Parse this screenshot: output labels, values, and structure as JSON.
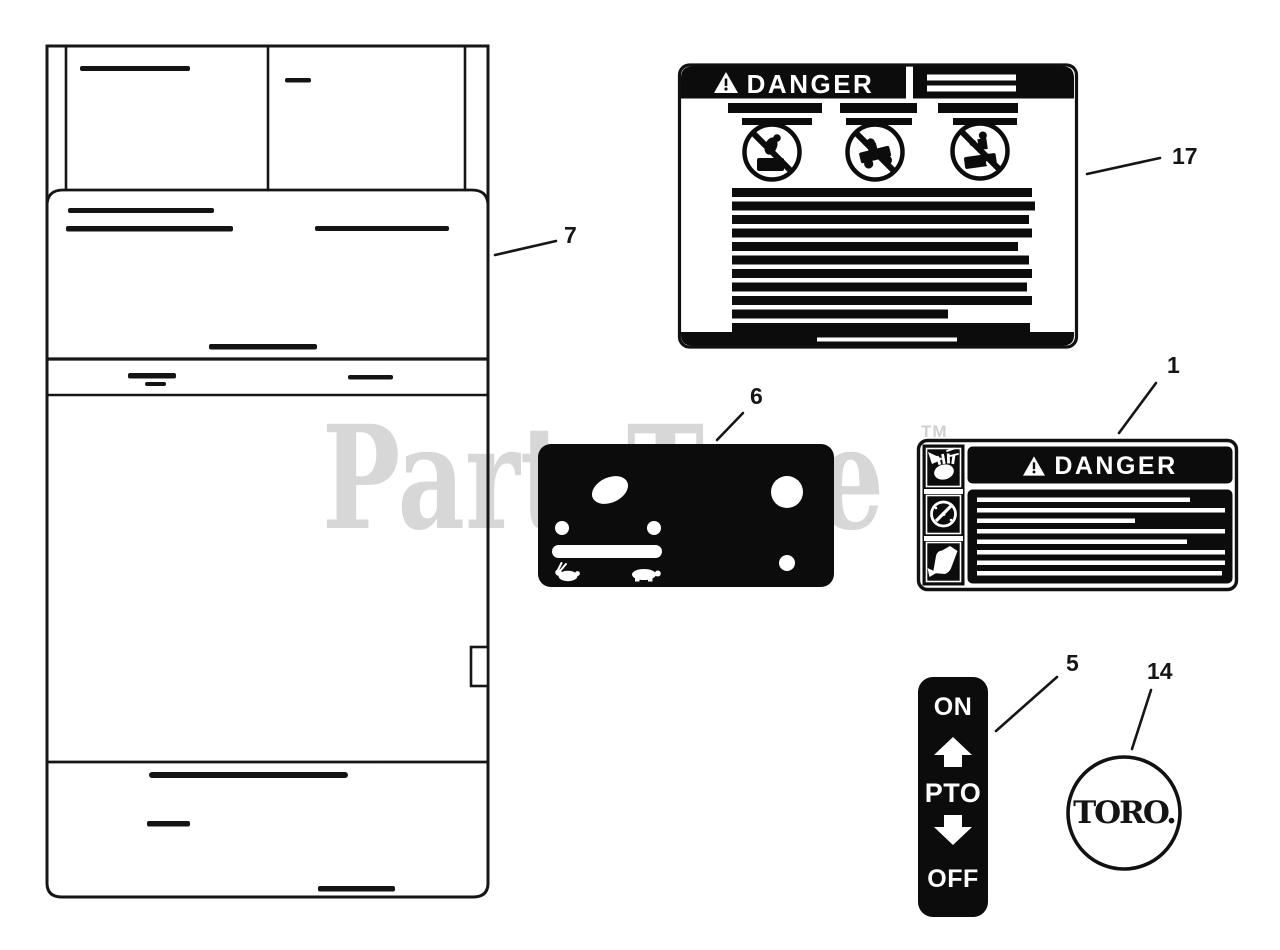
{
  "page": {
    "background": "#ffffff",
    "ink": "#111111"
  },
  "watermark": {
    "text": "PartsTree",
    "tm": "TM",
    "color": "#d7d7d7"
  },
  "callouts": {
    "sheet": "7",
    "danger_large": "17",
    "control_panel": "6",
    "danger_small": "1",
    "pto_switch": "5",
    "toro_logo": "14"
  },
  "decals": {
    "danger_large": {
      "title": "DANGER"
    },
    "danger_small": {
      "title": "DANGER"
    },
    "pto_switch": {
      "top": "ON",
      "middle": "PTO",
      "bottom": "OFF"
    },
    "toro_logo": {
      "brand": "TORO."
    }
  },
  "icons": {
    "warning_triangle": "solid triangle with exclamation mark",
    "prohibition_circle": "circle with diagonal slash over rider/mower pictogram",
    "rabbit": "fast throttle symbol",
    "turtle": "slow throttle symbol",
    "hand_blade": "hand cut by blade pictogram",
    "gauge_blade": "rotating blade dial pictogram",
    "boot_blade": "foot cut by blade pictogram",
    "up_arrow": "PTO engage arrow",
    "down_arrow": "PTO disengage arrow"
  }
}
